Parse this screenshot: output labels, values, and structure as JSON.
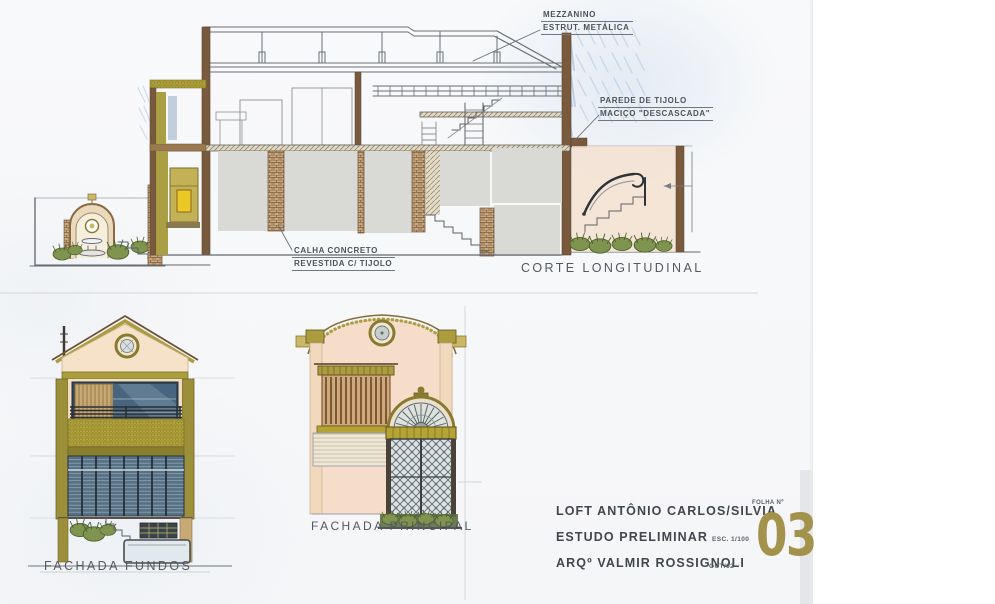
{
  "titles": {
    "section": "CORTE LONGITUDINAL",
    "front_facade": "FACHADA PRINCIPAL",
    "back_facade": "FACHADA FUNDOS"
  },
  "annotations": {
    "mezzanine_line1": "MEZZANINO",
    "mezzanine_line2": "ESTRUT. METÁLICA",
    "brick_wall_line1": "PAREDE DE TIJOLO",
    "brick_wall_line2": "MACIÇO \"DESCASCADA\"",
    "gutter_line1": "CALHA CONCRETO",
    "gutter_line2": "REVESTIDA C/ TIJOLO"
  },
  "title_block": {
    "project": "LOFT ANTÔNIO CARLOS/SILVIA",
    "phase": "ESTUDO PRELIMINAR",
    "architect": "ARQº VALMIR ROSSIGNOLI",
    "scale": "ESC. 1/100",
    "date": "OUT/02",
    "sheet_label": "FOLHA Nº",
    "sheet_number": "03"
  },
  "colors": {
    "paper": "#f7f8f9",
    "ink": "#565b61",
    "pencil_blue": "#a9c2e2",
    "wood_brown": "#7a5a3d",
    "brick_tan": "#c8a87e",
    "olive": "#ab9d3d",
    "peach": "#f4e0ce",
    "glass_blue": "#47657e",
    "plant_green": "#7f944e",
    "block_gray": "#d9d9d5",
    "sheet_gold": "#a3924b"
  }
}
